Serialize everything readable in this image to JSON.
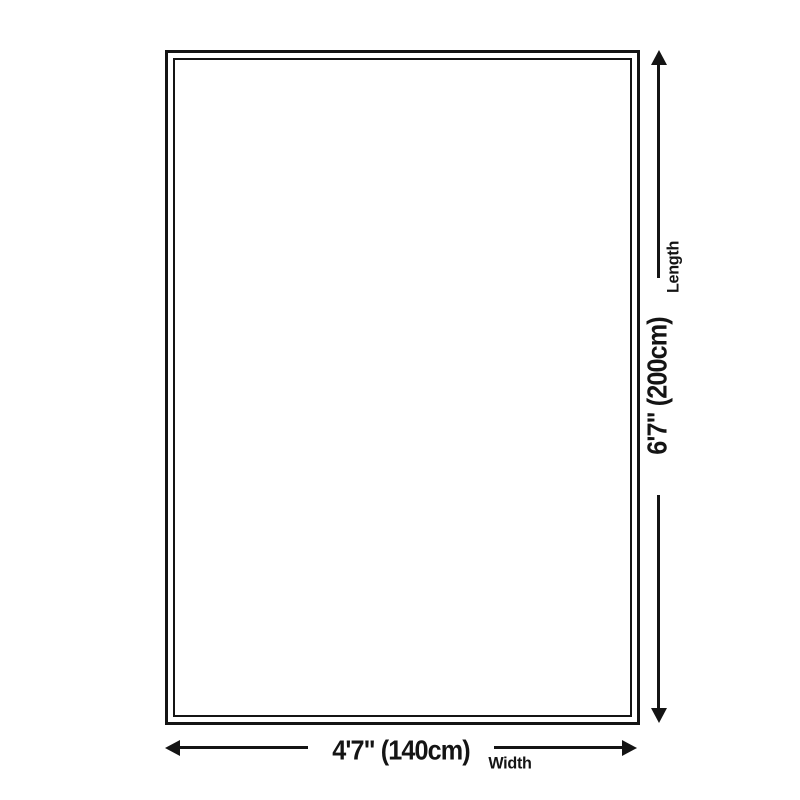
{
  "diagram": {
    "dimensions": {
      "length": {
        "value": "6'7\" (200cm)",
        "label": "Length"
      },
      "width": {
        "value": "4'7\" (140cm)",
        "label": "Width"
      }
    },
    "icons": {
      "arrow_up": "arrow-up-icon",
      "arrow_down": "arrow-down-icon",
      "arrow_left": "arrow-left-icon",
      "arrow_right": "arrow-right-icon"
    },
    "colors": {
      "line": "#141414",
      "background": "#ffffff"
    }
  }
}
